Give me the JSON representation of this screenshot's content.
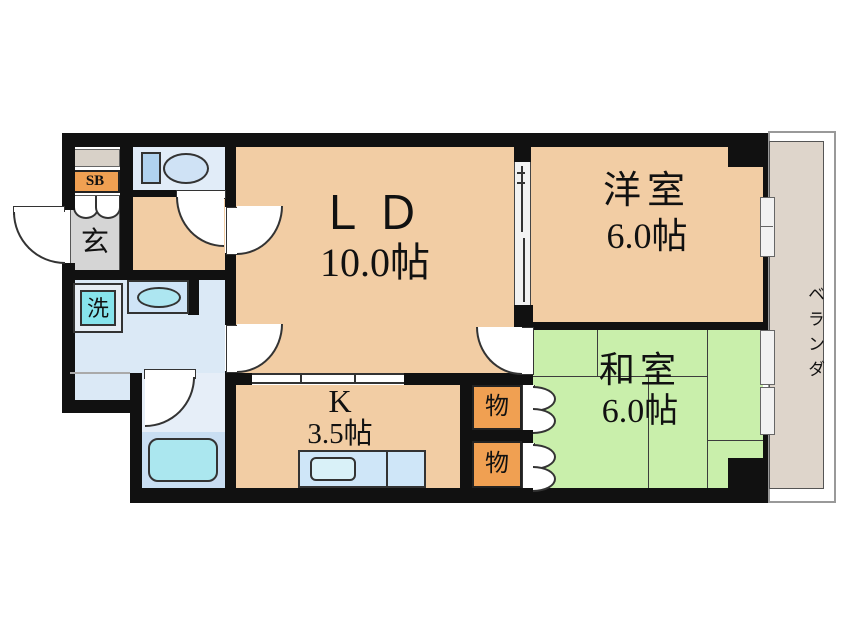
{
  "plan": {
    "type": "floor-plan",
    "rooms": {
      "ld": {
        "label": "ＬＤ",
        "size": "10.0帖"
      },
      "yoshitsu": {
        "label": "洋室",
        "size": "6.0帖"
      },
      "washitsu": {
        "label": "和室",
        "size": "6.0帖"
      },
      "kitchen": {
        "label": "K",
        "size": "3.5帖"
      },
      "genkan": {
        "label": "玄"
      },
      "shoebox": {
        "label": "SB"
      },
      "laundry": {
        "label": "洗"
      },
      "storage_upper": {
        "label": "物"
      },
      "storage_lower": {
        "label": "物"
      },
      "veranda": {
        "label": "ベランダ"
      }
    },
    "icons": {
      "toilet": "toilet-icon",
      "bathtub": "bathtub-icon",
      "washing_machine": "washing-machine-icon",
      "vanity_sink": "sink-icon",
      "kitchen_sink": "kitchen-sink-icon"
    },
    "colors": {
      "wall_black": "#111111",
      "room_peach": "#f2cda4",
      "tatami_green": "#c9efab",
      "storage_orange": "#f0a052",
      "wet_area_blue": "#dbe9f6",
      "bath_blue": "#e6eef8",
      "tub_band_blue": "#c9def2",
      "tub_cyan": "#abe7ef",
      "counter_blue": "#cfe6f8",
      "entrance_gray": "#d5d5d5",
      "veranda_beige": "#ded5cb"
    }
  }
}
